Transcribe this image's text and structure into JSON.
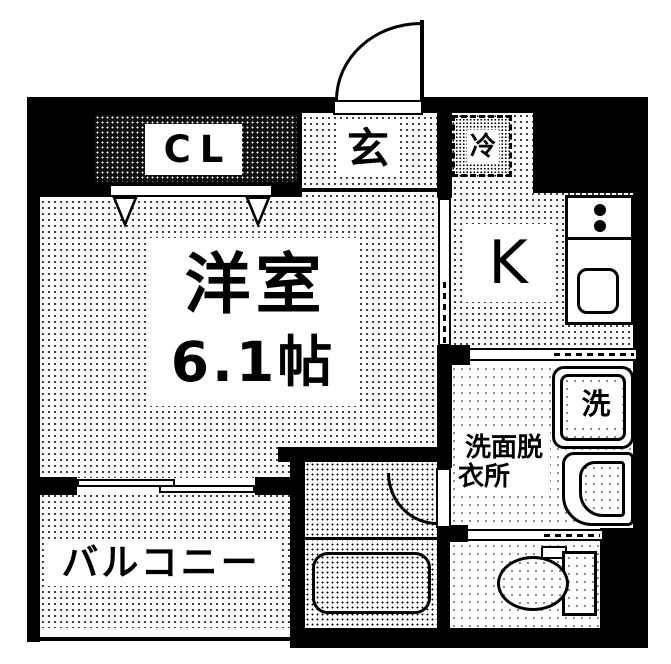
{
  "plan_title": "apartment-floor-plan",
  "colors": {
    "wall": "#000000",
    "background": "#ffffff",
    "floor_dots": "#000000",
    "text": "#000000"
  },
  "rooms": {
    "closet": {
      "label": "CL"
    },
    "entrance": {
      "label": "玄"
    },
    "refrigerator_space": {
      "label": "冷"
    },
    "kitchen": {
      "label": "K"
    },
    "western_room": {
      "name": "洋室",
      "size": "6.1帖"
    },
    "washroom": {
      "label_line1": "洗面脱",
      "label_line2": "衣所"
    },
    "washing_machine": {
      "label": "洗"
    },
    "balcony": {
      "label": "バルコニー"
    }
  }
}
